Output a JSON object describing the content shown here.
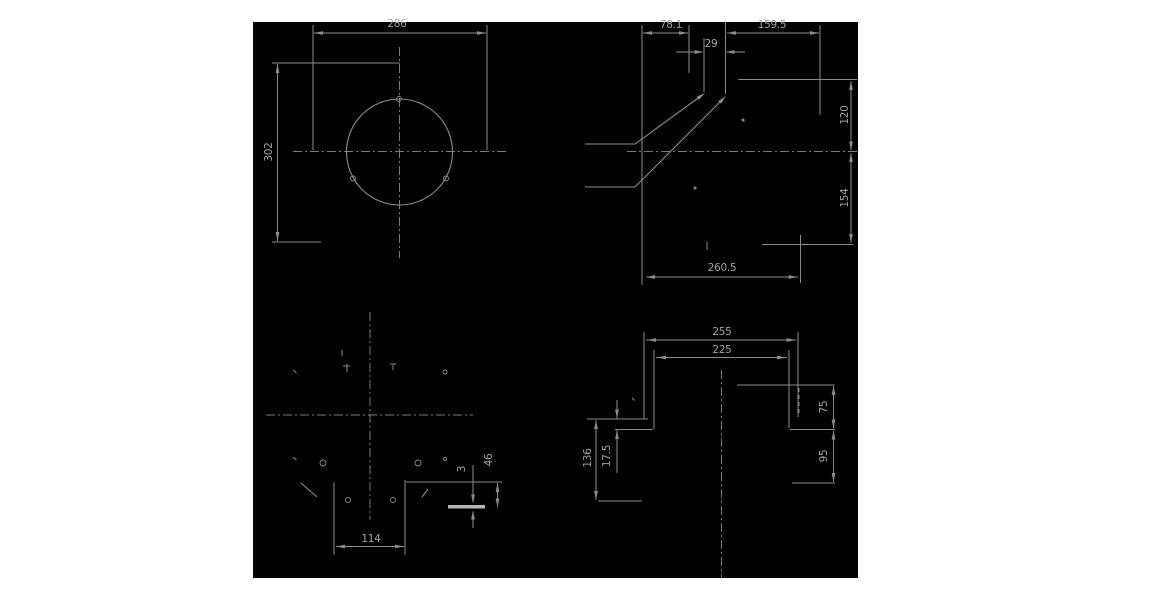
{
  "document": {
    "type": "engineering-drawing",
    "description": "Four-view CAD technical drawing, gray lines on black background"
  },
  "colors": {
    "page_bg": "#ffffff",
    "drawing_bg": "#000000",
    "line": "#8b8b8b",
    "center_line": "#7c7c7c",
    "text": "#a2a2a2",
    "thick_line": "#b5b5b5"
  },
  "canvas": {
    "left": 253,
    "top": 22,
    "width": 605,
    "height": 556
  },
  "dimension_labels": [
    {
      "text": "286",
      "x": 397,
      "y": 24,
      "rot": 0
    },
    {
      "text": "302",
      "x": 269,
      "y": 152,
      "rot": -90
    },
    {
      "text": "78.1",
      "x": 671,
      "y": 25,
      "rot": 0
    },
    {
      "text": "29",
      "x": 711,
      "y": 44,
      "rot": 0
    },
    {
      "text": "159.5",
      "x": 772,
      "y": 25,
      "rot": 0
    },
    {
      "text": "120",
      "x": 845,
      "y": 115,
      "rot": -90
    },
    {
      "text": "154",
      "x": 845,
      "y": 198,
      "rot": -90
    },
    {
      "text": "260.5",
      "x": 722,
      "y": 268,
      "rot": 0
    },
    {
      "text": "255",
      "x": 722,
      "y": 332,
      "rot": 0
    },
    {
      "text": "225",
      "x": 722,
      "y": 350,
      "rot": 0
    },
    {
      "text": "136",
      "x": 588,
      "y": 458,
      "rot": -90
    },
    {
      "text": "17.5",
      "x": 607,
      "y": 456,
      "rot": -90
    },
    {
      "text": "75",
      "x": 824,
      "y": 407,
      "rot": -90
    },
    {
      "text": "95",
      "x": 824,
      "y": 456,
      "rot": -90
    },
    {
      "text": "114",
      "x": 371,
      "y": 539,
      "rot": 0
    },
    {
      "text": "46",
      "x": 489,
      "y": 460,
      "rot": -90
    },
    {
      "text": "3",
      "x": 462,
      "y": 469,
      "rot": -90
    }
  ],
  "geometry": {
    "segments": [
      [
        399.5,
        47,
        399.5,
        258,
        "c"
      ],
      [
        293,
        151.5,
        506,
        151.5,
        "c"
      ],
      [
        314,
        33,
        486,
        33,
        "d"
      ],
      [
        313,
        25,
        313,
        150,
        "e"
      ],
      [
        487,
        25,
        487,
        150,
        "e"
      ],
      [
        277.5,
        64,
        277.5,
        241,
        "d"
      ],
      [
        272,
        63,
        400,
        63,
        "e"
      ],
      [
        272,
        242,
        321,
        242,
        "e"
      ],
      [
        585,
        144,
        635,
        144,
        "o"
      ],
      [
        585,
        187,
        635,
        187,
        "o"
      ],
      [
        635,
        144,
        703,
        94.5,
        "o"
      ],
      [
        635,
        187,
        724,
        98,
        "o"
      ],
      [
        738,
        79.5,
        857,
        79.5,
        "o"
      ],
      [
        762,
        244.5,
        853,
        244.5,
        "o"
      ],
      [
        627,
        151.5,
        857,
        151.5,
        "c"
      ],
      [
        643,
        33,
        688,
        33,
        "d"
      ],
      [
        642,
        25,
        642,
        285,
        "e"
      ],
      [
        689,
        25,
        689,
        73,
        "e"
      ],
      [
        727,
        33,
        819,
        33,
        "d"
      ],
      [
        820,
        25,
        820,
        115,
        "e"
      ],
      [
        676,
        52,
        702,
        52,
        "d"
      ],
      [
        727,
        52,
        745,
        52,
        "d"
      ],
      [
        704,
        38,
        704,
        92,
        "e"
      ],
      [
        725.5,
        22,
        725.5,
        94,
        "e"
      ],
      [
        851,
        81,
        851,
        150.5,
        "d"
      ],
      [
        851,
        153,
        851,
        243,
        "d"
      ],
      [
        646,
        277,
        798,
        277,
        "d"
      ],
      [
        800.5,
        235,
        800.5,
        283,
        "e"
      ],
      [
        707,
        242,
        707,
        250,
        "t"
      ],
      [
        742,
        119,
        744.5,
        121.5,
        "t"
      ],
      [
        694,
        187,
        696.5,
        189,
        "t"
      ],
      [
        370,
        312,
        370,
        520,
        "c"
      ],
      [
        266,
        415,
        473,
        415,
        "c"
      ],
      [
        334,
        482,
        334,
        555,
        "e"
      ],
      [
        405,
        480,
        405,
        555,
        "e"
      ],
      [
        406,
        482,
        502,
        482,
        "o"
      ],
      [
        301,
        483,
        317,
        497,
        "o"
      ],
      [
        428,
        489,
        422,
        497,
        "o"
      ],
      [
        336,
        546.5,
        404,
        546.5,
        "d"
      ],
      [
        497.5,
        483,
        497.5,
        507.5,
        "d"
      ],
      [
        473,
        465,
        473,
        502.5,
        "d"
      ],
      [
        473,
        511.5,
        473,
        528,
        "d"
      ],
      [
        342,
        350,
        342,
        356,
        "t"
      ],
      [
        347,
        364,
        347,
        372,
        "t"
      ],
      [
        343,
        366,
        350,
        366,
        "t"
      ],
      [
        390,
        364,
        396,
        364,
        "t"
      ],
      [
        393,
        365,
        393,
        370,
        "t"
      ],
      [
        293,
        370,
        296.5,
        373,
        "t"
      ],
      [
        293,
        457,
        296.5,
        460,
        "t"
      ],
      [
        721.5,
        370,
        721.5,
        578,
        "c"
      ],
      [
        587,
        419,
        648,
        419,
        "o"
      ],
      [
        615,
        429.5,
        653,
        429.5,
        "o"
      ],
      [
        598,
        501,
        642,
        501,
        "o"
      ],
      [
        737,
        385,
        835,
        385,
        "o"
      ],
      [
        790,
        429.5,
        835,
        429.5,
        "o"
      ],
      [
        792,
        483,
        835,
        483,
        "o"
      ],
      [
        799,
        388,
        799,
        415,
        "h"
      ],
      [
        646,
        340,
        796,
        340,
        "d"
      ],
      [
        644,
        332,
        644,
        419,
        "e"
      ],
      [
        798,
        332,
        798,
        417,
        "e"
      ],
      [
        656,
        357.5,
        787,
        357.5,
        "d"
      ],
      [
        654,
        350,
        654,
        429,
        "e"
      ],
      [
        789,
        350,
        789,
        428,
        "e"
      ],
      [
        596,
        420,
        596,
        500,
        "d"
      ],
      [
        617,
        400,
        617,
        418.5,
        "d"
      ],
      [
        617,
        430,
        617,
        473,
        "d"
      ],
      [
        833.5,
        386,
        833.5,
        428.5,
        "d"
      ],
      [
        833.5,
        430.5,
        833.5,
        482,
        "d"
      ],
      [
        632,
        398,
        634.5,
        400.5,
        "t"
      ]
    ],
    "arrows": [
      [
        314,
        33,
        180
      ],
      [
        486,
        33,
        0
      ],
      [
        277.5,
        64,
        270
      ],
      [
        277.5,
        241,
        90
      ],
      [
        643,
        33,
        180
      ],
      [
        688,
        33,
        0
      ],
      [
        727,
        33,
        180
      ],
      [
        819,
        33,
        0
      ],
      [
        703.5,
        52,
        0
      ],
      [
        725.5,
        52,
        180
      ],
      [
        705,
        93,
        -36
      ],
      [
        726,
        96,
        -45
      ],
      [
        851,
        81,
        270
      ],
      [
        851,
        150.5,
        90
      ],
      [
        851,
        153,
        270
      ],
      [
        851,
        243,
        90
      ],
      [
        646,
        277,
        180
      ],
      [
        797.5,
        277,
        0
      ],
      [
        336,
        546.5,
        180
      ],
      [
        404,
        546.5,
        0
      ],
      [
        497.5,
        483,
        270
      ],
      [
        497.5,
        507.5,
        90
      ],
      [
        473,
        503.5,
        90
      ],
      [
        473,
        510.5,
        270
      ],
      [
        647,
        340,
        180
      ],
      [
        795.5,
        340,
        0
      ],
      [
        657,
        357.5,
        180
      ],
      [
        786,
        357.5,
        0
      ],
      [
        596,
        420,
        270
      ],
      [
        596,
        500,
        90
      ],
      [
        617,
        418.5,
        90
      ],
      [
        617,
        430,
        270
      ],
      [
        833.5,
        386,
        270
      ],
      [
        833.5,
        428.5,
        90
      ],
      [
        833.5,
        430.5,
        270
      ],
      [
        833.5,
        482,
        90
      ]
    ],
    "circles": [
      [
        399.5,
        152,
        53,
        "o"
      ],
      [
        399,
        99,
        2.5,
        "o"
      ],
      [
        353,
        178.5,
        2.5,
        "o"
      ],
      [
        446,
        178.5,
        2.5,
        "o"
      ],
      [
        323,
        463,
        3,
        "o"
      ],
      [
        418,
        463,
        3,
        "o"
      ],
      [
        348,
        500,
        2.5,
        "o"
      ],
      [
        393,
        500,
        2.5,
        "o"
      ],
      [
        445,
        372,
        2,
        "o"
      ],
      [
        445,
        459,
        1.5,
        "o"
      ],
      [
        743,
        120,
        1,
        "t"
      ],
      [
        695,
        188,
        1,
        "t"
      ]
    ],
    "thick_segments": [
      {
        "x": 448,
        "y": 505,
        "w": 37,
        "h": 3.5
      }
    ]
  }
}
